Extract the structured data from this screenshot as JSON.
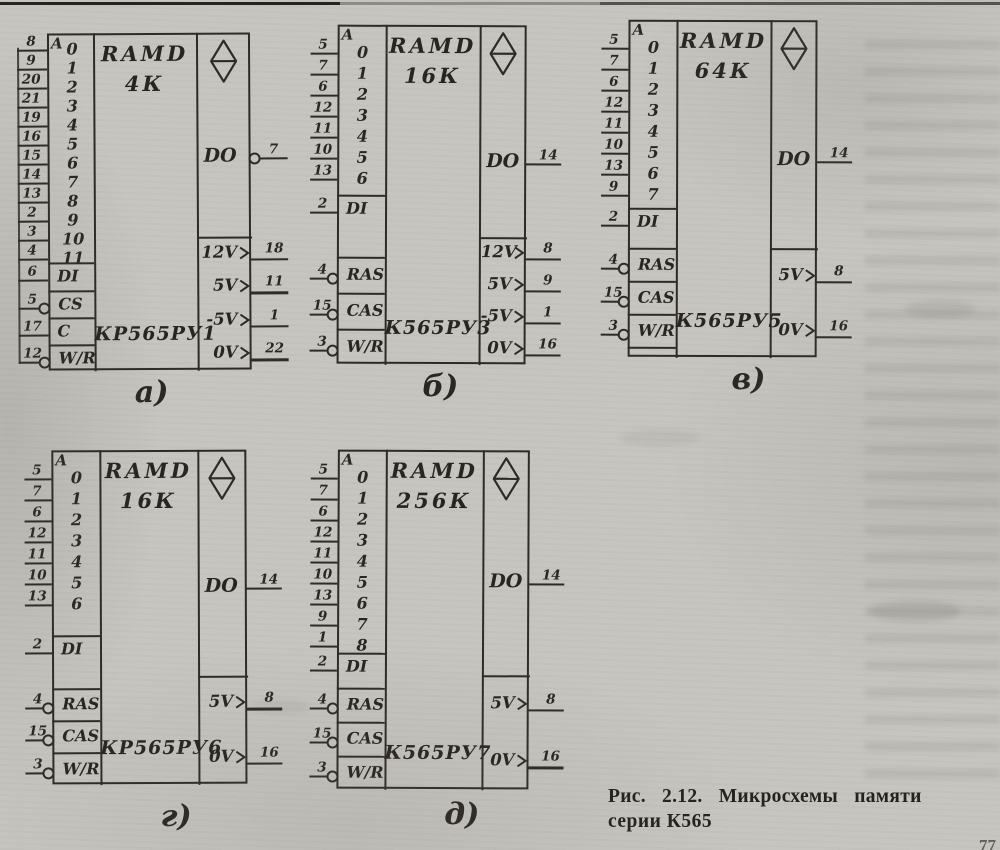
{
  "page": {
    "caption_line1": "Рис. 2.12. Микросхемы памяти",
    "caption_line2": "серии К565",
    "page_number": "77"
  },
  "chips": [
    {
      "id": "a",
      "label": "а)",
      "device_type": "RAMD",
      "capacity": "4К",
      "name": "КР565РУ1",
      "address_header": "A",
      "address_pins": [
        {
          "pin": "8",
          "index": "0"
        },
        {
          "pin": "9",
          "index": "1"
        },
        {
          "pin": "20",
          "index": "2"
        },
        {
          "pin": "21",
          "index": "3"
        },
        {
          "pin": "19",
          "index": "4"
        },
        {
          "pin": "16",
          "index": "5"
        },
        {
          "pin": "15",
          "index": "6"
        },
        {
          "pin": "14",
          "index": "7"
        },
        {
          "pin": "13",
          "index": "8"
        },
        {
          "pin": "2",
          "index": "9"
        },
        {
          "pin": "3",
          "index": "10"
        },
        {
          "pin": "4",
          "index": "11"
        }
      ],
      "data_in": {
        "label": "DI",
        "pin": "6",
        "bubble": false
      },
      "controls": [
        {
          "label": "CS",
          "pin": "5",
          "bubble": true
        },
        {
          "label": "C",
          "pin": "17",
          "bubble": false
        },
        {
          "label": "W/R",
          "pin": "12",
          "bubble": true
        }
      ],
      "data_out": {
        "label": "DO",
        "pin": "7",
        "bubble": true
      },
      "power_pins": [
        {
          "label": "12V",
          "pin": "18"
        },
        {
          "label": "5V",
          "pin": "11"
        },
        {
          "label": "-5V",
          "pin": "1"
        },
        {
          "label": "0V",
          "pin": "22"
        }
      ]
    },
    {
      "id": "b",
      "label": "б)",
      "device_type": "RAMD",
      "capacity": "16К",
      "name": "К565РУ3",
      "address_header": "A",
      "address_pins": [
        {
          "pin": "5",
          "index": "0"
        },
        {
          "pin": "7",
          "index": "1"
        },
        {
          "pin": "6",
          "index": "2"
        },
        {
          "pin": "12",
          "index": "3"
        },
        {
          "pin": "11",
          "index": "4"
        },
        {
          "pin": "10",
          "index": "5"
        },
        {
          "pin": "13",
          "index": "6"
        }
      ],
      "data_in": {
        "label": "DI",
        "pin": "2",
        "bubble": false
      },
      "controls": [
        {
          "label": "RAS",
          "pin": "4",
          "bubble": true
        },
        {
          "label": "CAS",
          "pin": "15",
          "bubble": true
        },
        {
          "label": "W/R",
          "pin": "3",
          "bubble": true
        }
      ],
      "data_out": {
        "label": "DO",
        "pin": "14",
        "bubble": false
      },
      "power_pins": [
        {
          "label": "12V",
          "pin": "8"
        },
        {
          "label": "5V",
          "pin": "9"
        },
        {
          "label": "-5V",
          "pin": "1"
        },
        {
          "label": "0V",
          "pin": "16"
        }
      ]
    },
    {
      "id": "v",
      "label": "в)",
      "device_type": "RAMD",
      "capacity": "64К",
      "name": "К565РУ5",
      "address_header": "A",
      "address_pins": [
        {
          "pin": "5",
          "index": "0"
        },
        {
          "pin": "7",
          "index": "1"
        },
        {
          "pin": "6",
          "index": "2"
        },
        {
          "pin": "12",
          "index": "3"
        },
        {
          "pin": "11",
          "index": "4"
        },
        {
          "pin": "10",
          "index": "5"
        },
        {
          "pin": "13",
          "index": "6"
        },
        {
          "pin": "9",
          "index": "7"
        }
      ],
      "data_in": {
        "label": "DI",
        "pin": "2",
        "bubble": false
      },
      "controls": [
        {
          "label": "RAS",
          "pin": "4",
          "bubble": true
        },
        {
          "label": "CAS",
          "pin": "15",
          "bubble": true
        },
        {
          "label": "W/R",
          "pin": "3",
          "bubble": true
        }
      ],
      "data_out": {
        "label": "DO",
        "pin": "14",
        "bubble": false
      },
      "power_pins": [
        {
          "label": "5V",
          "pin": "8"
        },
        {
          "label": "0V",
          "pin": "16"
        }
      ]
    },
    {
      "id": "g",
      "label": "г)",
      "device_type": "RAMD",
      "capacity": "16К",
      "name": "КР565РУ6",
      "address_header": "A",
      "address_pins": [
        {
          "pin": "5",
          "index": "0"
        },
        {
          "pin": "7",
          "index": "1"
        },
        {
          "pin": "6",
          "index": "2"
        },
        {
          "pin": "12",
          "index": "3"
        },
        {
          "pin": "11",
          "index": "4"
        },
        {
          "pin": "10",
          "index": "5"
        },
        {
          "pin": "13",
          "index": "6"
        }
      ],
      "data_in": {
        "label": "DI",
        "pin": "2",
        "bubble": false
      },
      "controls": [
        {
          "label": "RAS",
          "pin": "4",
          "bubble": true
        },
        {
          "label": "CAS",
          "pin": "15",
          "bubble": true
        },
        {
          "label": "W/R",
          "pin": "3",
          "bubble": true
        }
      ],
      "data_out": {
        "label": "DO",
        "pin": "14",
        "bubble": false
      },
      "power_pins": [
        {
          "label": "5V",
          "pin": "8"
        },
        {
          "label": "0V",
          "pin": "16"
        }
      ]
    },
    {
      "id": "d",
      "label": "д)",
      "device_type": "RAMD",
      "capacity": "256К",
      "name": "К565РУ7",
      "address_header": "A",
      "address_pins": [
        {
          "pin": "5",
          "index": "0"
        },
        {
          "pin": "7",
          "index": "1"
        },
        {
          "pin": "6",
          "index": "2"
        },
        {
          "pin": "12",
          "index": "3"
        },
        {
          "pin": "11",
          "index": "4"
        },
        {
          "pin": "10",
          "index": "5"
        },
        {
          "pin": "13",
          "index": "6"
        },
        {
          "pin": "9",
          "index": "7"
        },
        {
          "pin": "1",
          "index": "8"
        }
      ],
      "data_in": {
        "label": "DI",
        "pin": "2",
        "bubble": false
      },
      "controls": [
        {
          "label": "RAS",
          "pin": "4",
          "bubble": true
        },
        {
          "label": "CAS",
          "pin": "15",
          "bubble": true
        },
        {
          "label": "W/R",
          "pin": "3",
          "bubble": true
        }
      ],
      "data_out": {
        "label": "DO",
        "pin": "14",
        "bubble": false
      },
      "power_pins": [
        {
          "label": "5V",
          "pin": "8"
        },
        {
          "label": "0V",
          "pin": "16"
        }
      ]
    }
  ]
}
